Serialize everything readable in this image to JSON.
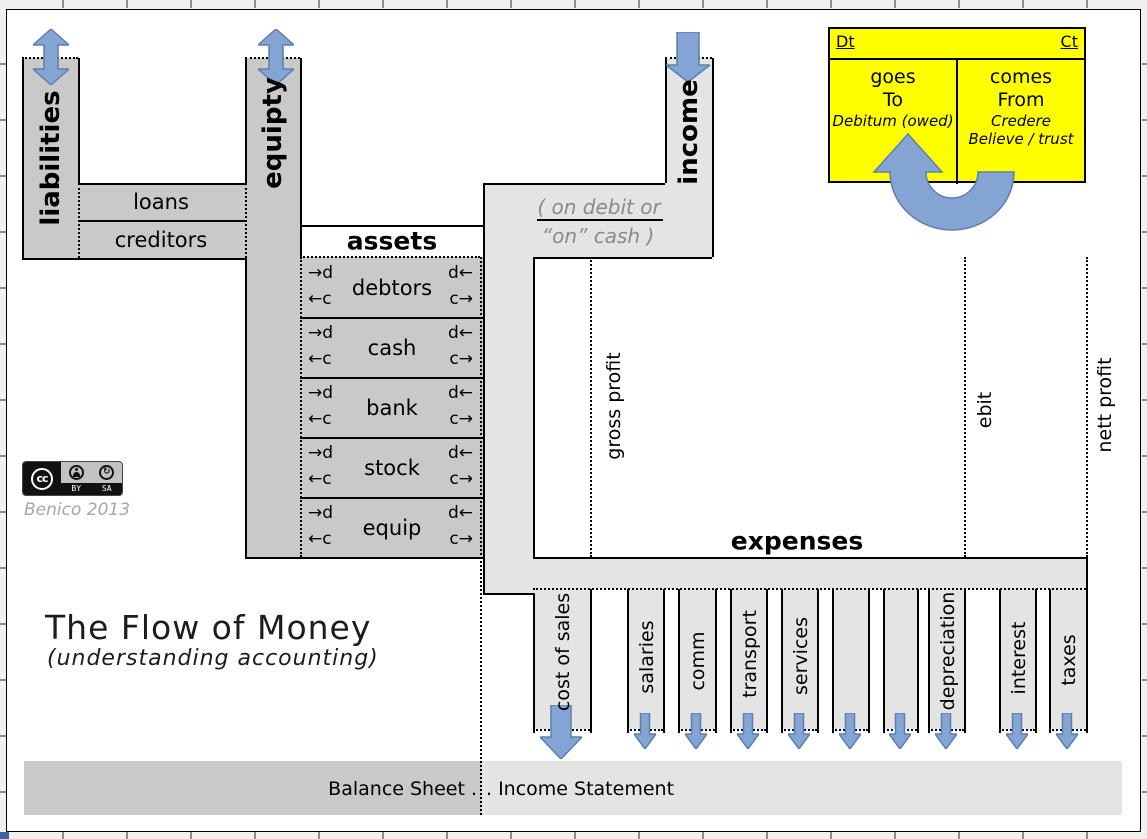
{
  "colors": {
    "accent_blue": "#84a4d4",
    "accent_blue_border": "#5d7fae",
    "dark_gray": "#c9c9c9",
    "light_gray": "#e4e4e4",
    "yellow": "#ffff00"
  },
  "balance_sheet": {
    "liabilities_label": "liabilities",
    "equity_label": "equipty",
    "loans_label": "loans",
    "creditors_label": "creditors",
    "assets_heading": "assets",
    "asset_accounts": [
      {
        "name": "debtors"
      },
      {
        "name": "cash"
      },
      {
        "name": "bank"
      },
      {
        "name": "stock"
      },
      {
        "name": "equip"
      }
    ],
    "row_markers": {
      "debit_in": "→d",
      "credit_in": "←c",
      "debit_out": "d←",
      "credit_out": "c→"
    }
  },
  "income_statement": {
    "income_label": "income",
    "cash_note_line1": "( on debit or",
    "cash_note_line2": "“on” cash )",
    "expenses_heading": "expenses",
    "profit_markers": [
      {
        "label": "gross profit"
      },
      {
        "label": "ebit"
      },
      {
        "label": "nett profit"
      }
    ],
    "expense_channels": [
      {
        "label": "cost of sales"
      },
      {
        "label": "salaries"
      },
      {
        "label": "comm"
      },
      {
        "label": "transport"
      },
      {
        "label": "services"
      },
      {
        "label": ""
      },
      {
        "label": ""
      },
      {
        "label": "depreciation"
      },
      {
        "label": "interest"
      },
      {
        "label": "taxes"
      }
    ]
  },
  "debit_credit_box": {
    "debit_abbr": "Dt",
    "credit_abbr": "Ct",
    "debit_line1": "goes",
    "debit_line2": "To",
    "debit_etymology": "Debitum (owed)",
    "credit_line1": "comes",
    "credit_line2": "From",
    "credit_etymology1": "Credere",
    "credit_etymology2": "Believe / trust"
  },
  "title": {
    "main": "The Flow of Money",
    "subtitle": "(understanding accounting)"
  },
  "license": {
    "cc": "cc",
    "by": "BY",
    "sa": "SA",
    "credit": "Benico 2013"
  },
  "footer": {
    "balance_sheet_label": "Balance Sheet .",
    "income_statement_label": ". Income Statement"
  }
}
